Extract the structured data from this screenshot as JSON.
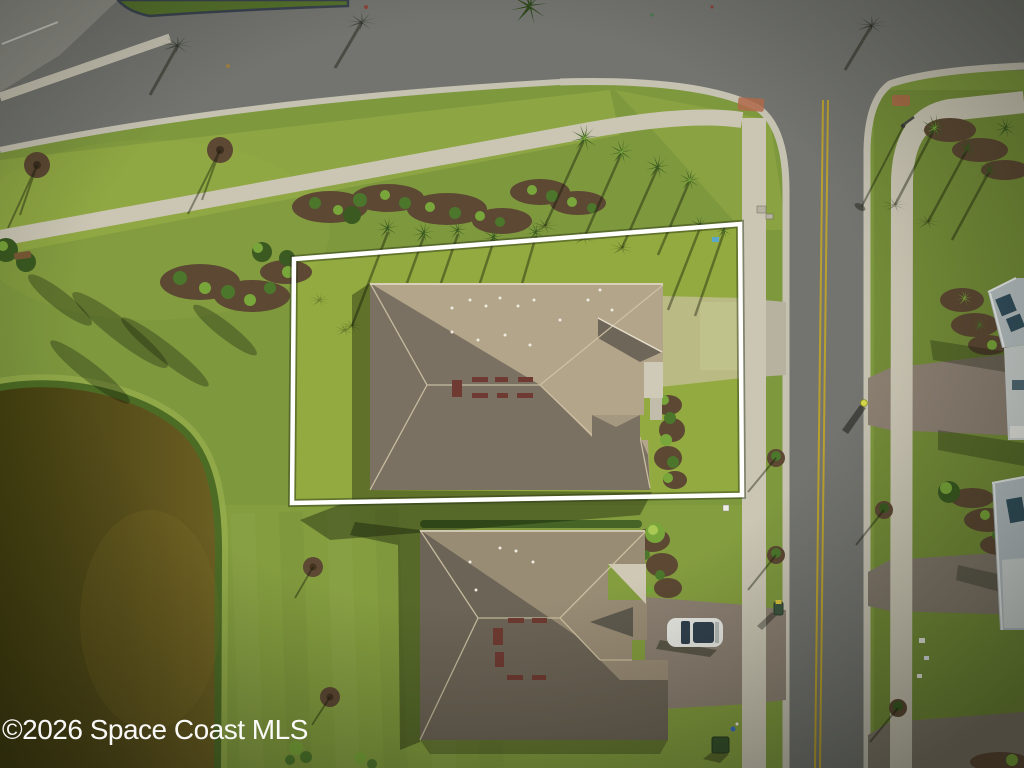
{
  "watermark": {
    "text": "©2026 Space Coast MLS"
  },
  "palette": {
    "grass_base": "#7e983e",
    "grass_bright": "#aabf4e",
    "grass_dark": "#5c7a2e",
    "road": "#73746f",
    "road_light": "#8c8c85",
    "curb": "#c6c2b2",
    "sidewalk": "#cbc6b4",
    "yellow": "#b9a02e",
    "pond_dark": "#43400f",
    "pond_light": "#6b5e22",
    "reed": "#41601f",
    "reed_bright": "#9ab14e",
    "mulch": "#5c4833",
    "shrub": "#4c762c",
    "shrub_light": "#79a63a",
    "canopy": "#3a5a21",
    "roof1_lit": "#b2a58a",
    "roof1_dark": "#7b7163",
    "roof1_mid": "#6f665a",
    "roof2_lit": "#998c75",
    "roof2_dark": "#6c6456",
    "vent": "#6e3a31",
    "driveway_concrete": "#b7b1a0",
    "paver": "#8c8072",
    "paver_dark": "#80776a",
    "boundary": "#ffffff",
    "car_body": "#e9e9e4",
    "car_glass": "#31414e",
    "roofA": "#b9c2c4",
    "panel": "#32505e",
    "wallA": "#ccd2d0",
    "watermark_color": "#ffffff"
  }
}
